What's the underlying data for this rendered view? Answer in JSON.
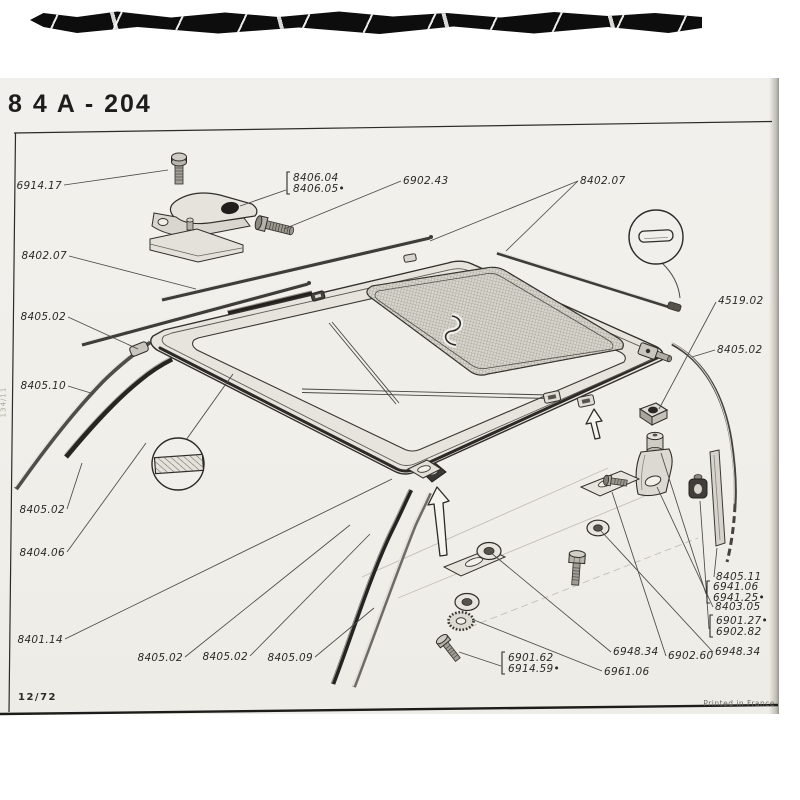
{
  "page": {
    "header": {
      "title": "8 4 A - 204"
    },
    "footer": {
      "left": "12/72",
      "right": "Printed in France"
    },
    "side_note": "134/11"
  },
  "colors": {
    "paper": "#f1efeb",
    "ink": "#262624",
    "scan_bar": "#0d0d0d"
  },
  "diagram": {
    "subject": "sunroof-roof-panel-exploded-view",
    "detail_views": [
      "seal-cross-section-hatched",
      "trim-profile-cross-section"
    ],
    "labels": [
      {
        "lines": [
          "6914.17"
        ],
        "x": 62,
        "y": 189,
        "align": "end",
        "leaders": [
          [
            64,
            185,
            168,
            170
          ]
        ]
      },
      {
        "lines": [
          "8406.04",
          "8406.05•"
        ],
        "x": 293,
        "y": 181,
        "align": "start",
        "bracket": true,
        "leaders": [
          [
            286,
            190,
            240,
            206
          ]
        ]
      },
      {
        "lines": [
          "6902.43"
        ],
        "x": 403,
        "y": 184,
        "align": "start",
        "leaders": [
          [
            401,
            181,
            284,
            229
          ]
        ]
      },
      {
        "lines": [
          "8402.07"
        ],
        "x": 580,
        "y": 184,
        "align": "start",
        "leaders": [
          [
            578,
            181,
            430,
            241
          ],
          [
            578,
            181,
            506,
            251
          ]
        ]
      },
      {
        "lines": [
          "8402.07"
        ],
        "x": 67,
        "y": 259,
        "align": "end",
        "leaders": [
          [
            69,
            256,
            196,
            289
          ]
        ]
      },
      {
        "lines": [
          "8405.02"
        ],
        "x": 66,
        "y": 320,
        "align": "end",
        "leaders": [
          [
            68,
            317,
            138,
            349
          ]
        ]
      },
      {
        "lines": [
          "8405.10"
        ],
        "x": 66,
        "y": 389,
        "align": "end",
        "leaders": [
          [
            68,
            386,
            94,
            394
          ]
        ]
      },
      {
        "lines": [
          "8405.02"
        ],
        "x": 65,
        "y": 513,
        "align": "end",
        "leaders": [
          [
            67,
            509,
            82,
            463
          ]
        ]
      },
      {
        "lines": [
          "8404.06"
        ],
        "x": 65,
        "y": 556,
        "align": "end",
        "leaders": [
          [
            67,
            552,
            146,
            443
          ]
        ]
      },
      {
        "lines": [
          "8401.14"
        ],
        "x": 63,
        "y": 643,
        "align": "end",
        "leaders": [
          [
            65,
            639,
            392,
            479
          ]
        ]
      },
      {
        "lines": [
          "8405.02"
        ],
        "x": 183,
        "y": 661,
        "align": "end",
        "leaders": [
          [
            185,
            657,
            350,
            525
          ]
        ]
      },
      {
        "lines": [
          "8405.02"
        ],
        "x": 248,
        "y": 660,
        "align": "end",
        "leaders": [
          [
            250,
            656,
            370,
            534
          ]
        ]
      },
      {
        "lines": [
          "8405.09"
        ],
        "x": 313,
        "y": 661,
        "align": "end",
        "leaders": [
          [
            315,
            657,
            374,
            608
          ]
        ]
      },
      {
        "lines": [
          "6901.62",
          "6914.59•"
        ],
        "x": 508,
        "y": 661,
        "align": "start",
        "bracket": true,
        "leaders": [
          [
            501,
            666,
            459,
            652
          ]
        ]
      },
      {
        "lines": [
          "6961.06"
        ],
        "x": 604,
        "y": 675,
        "align": "start",
        "leaders": [
          [
            602,
            671,
            474,
            620
          ]
        ]
      },
      {
        "lines": [
          "6948.34"
        ],
        "x": 613,
        "y": 655,
        "align": "start",
        "leaders": [
          [
            611,
            652,
            490,
            552
          ]
        ]
      },
      {
        "lines": [
          "6902.60"
        ],
        "x": 668,
        "y": 659,
        "align": "start",
        "leaders": [
          [
            666,
            656,
            612,
            492
          ]
        ]
      },
      {
        "lines": [
          "6948.34"
        ],
        "x": 715,
        "y": 655,
        "align": "start",
        "leaders": [
          [
            713,
            652,
            601,
            531
          ]
        ]
      },
      {
        "lines": [
          "6901.27•",
          "6902.82"
        ],
        "x": 716,
        "y": 624,
        "align": "start",
        "bracket": true,
        "leaders": [
          [
            709,
            629,
            700,
            501
          ]
        ]
      },
      {
        "lines": [
          "8403.05"
        ],
        "x": 715,
        "y": 610,
        "align": "start",
        "leaders": [
          [
            713,
            607,
            657,
            487
          ]
        ]
      },
      {
        "lines": [
          "6941.06",
          "6941.25•"
        ],
        "x": 713,
        "y": 590,
        "align": "start",
        "bracket": true,
        "leaders": [
          [
            706,
            594,
            661,
            453
          ]
        ]
      },
      {
        "lines": [
          "8405.11"
        ],
        "x": 716,
        "y": 580,
        "align": "start",
        "leaders": [
          [
            714,
            577,
            717,
            548
          ]
        ]
      },
      {
        "lines": [
          "4519.02"
        ],
        "x": 718,
        "y": 304,
        "align": "start",
        "leaders": [
          [
            716,
            302,
            659,
            409
          ]
        ]
      },
      {
        "lines": [
          "8405.02"
        ],
        "x": 717,
        "y": 353,
        "align": "start",
        "leaders": [
          [
            715,
            350,
            692,
            357
          ]
        ]
      }
    ]
  }
}
